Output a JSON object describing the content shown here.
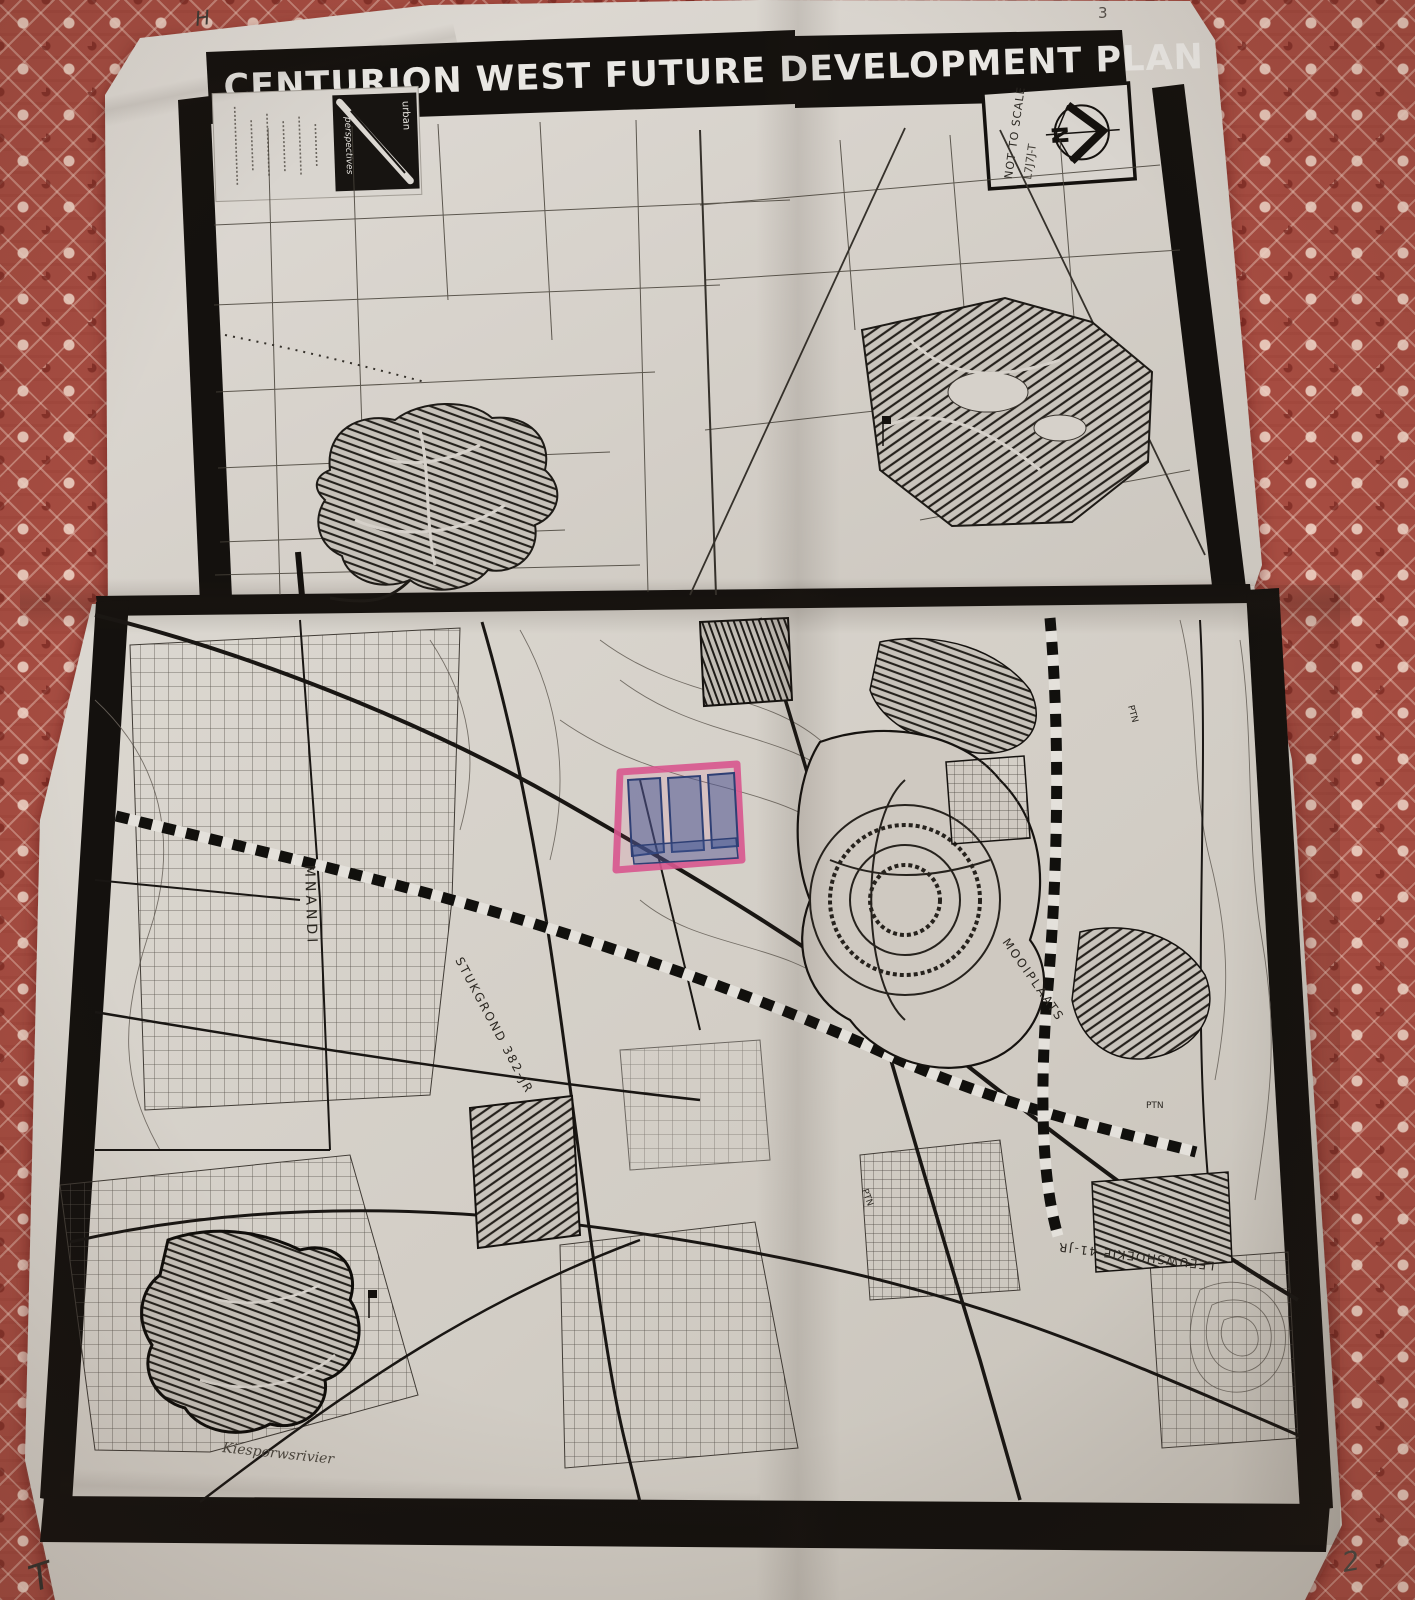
{
  "title": "CENTURION WEST FUTURE DEVELOPMENT PLAN",
  "page_marks": {
    "top_left": "H",
    "top_right": "3",
    "bottom_left": "T",
    "bottom_right": "2"
  },
  "logo_box": {
    "brand_top": "urban",
    "brand_bottom": "perspectives"
  },
  "north_box": {
    "scale_note": "NOT TO SCALE",
    "scribble": "L7J7J-T",
    "north_letter": "N"
  },
  "map_labels": {
    "mnandi": "MNANDI",
    "stukgrond": "STUKGROND 382-JR",
    "mooiplaats": "MOOIPLAATS",
    "river": "Kiesporwsrivier",
    "leeuwshoekie": "LEEUWSHOEKIE 41-JR",
    "ptn_a": "PTN",
    "ptn_b": "PTN",
    "ptn_c": "PTN"
  },
  "colors": {
    "fabric": "#a64c41",
    "paper": "#d6d1ca",
    "ink": "#1b1916",
    "highlight_pink": "#d9578f",
    "highlight_blue": "#3f5694"
  }
}
